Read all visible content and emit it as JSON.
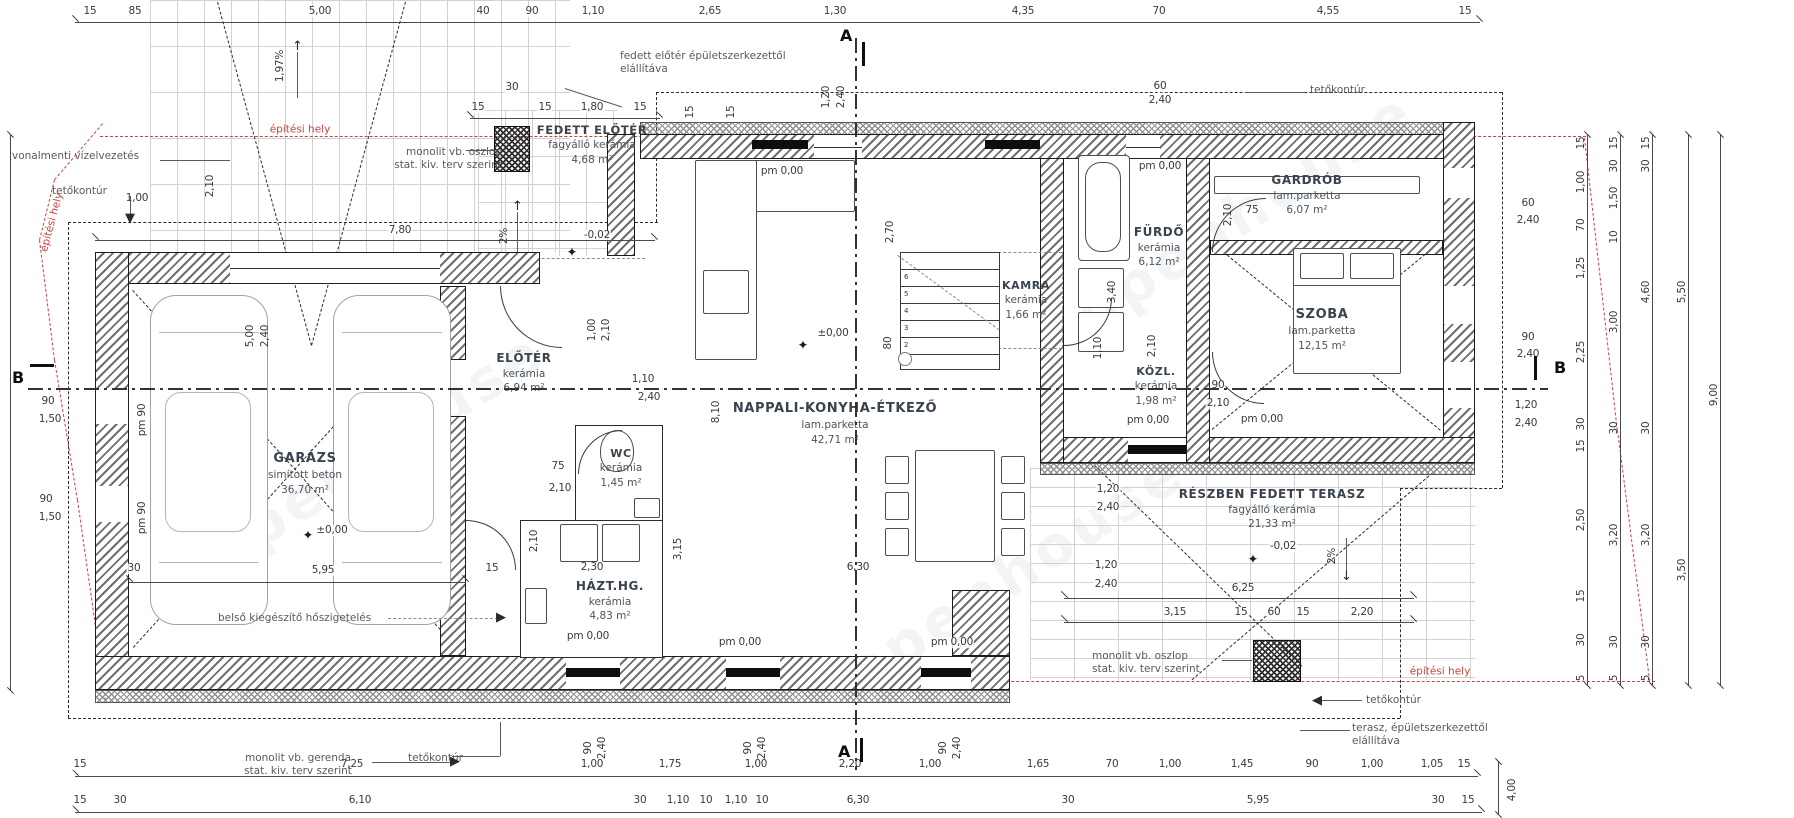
{
  "title": "Földszinti alaprajz",
  "colors": {
    "ink": "#1c1c1c",
    "dim_text": "#3a3a3a",
    "room_text": "#3a434e",
    "site_red": "#c6463e",
    "brick_gray": "#d2d2d2"
  },
  "rooms": [
    {
      "name": "GARÁZS",
      "finish": "simított beton",
      "area": "36,70 m²"
    },
    {
      "name": "FEDETT ELŐTÉR",
      "finish": "fagyálló kerámia",
      "area": "4,68 m²"
    },
    {
      "name": "ELŐTÉR",
      "finish": "kerámia",
      "area": "6,94 m²"
    },
    {
      "name": "WC",
      "finish": "kerámia",
      "area": "1,45 m²"
    },
    {
      "name": "HÁZT.HG.",
      "finish": "kerámia",
      "area": "4,83 m²"
    },
    {
      "name": "NAPPALI-KONYHA-ÉTKEZŐ",
      "finish": "lam.parketta",
      "area": "42,71 m²"
    },
    {
      "name": "KAMRA",
      "finish": "kerámia",
      "area": "1,66 m²"
    },
    {
      "name": "FÜRDŐ",
      "finish": "kerámia",
      "area": "6,12 m²"
    },
    {
      "name": "KÖZL.",
      "finish": "kerámia",
      "area": "1,98 m²"
    },
    {
      "name": "GARDRÓB",
      "finish": "lam.parketta",
      "area": "6,07 m²"
    },
    {
      "name": "SZOBA",
      "finish": "lam.parketta",
      "area": "12,15 m²"
    },
    {
      "name": "RÉSZBEN FEDETT TERASZ",
      "finish": "fagyálló kerámia",
      "area": "21,33 m²"
    }
  ],
  "levels": {
    "pm000": "pm 0,00",
    "pm90": "pm 90",
    "zero": "±0,00",
    "minus": "-0,02"
  },
  "sections": {
    "a": "A",
    "b": "B"
  },
  "annotations": {
    "vonalmenti": "vonalmenti vízelvezetés",
    "tetokontur": "tetőkontúr",
    "epitesi_hely": "építési hely",
    "oszlop_l1": "monolit vb. oszlop",
    "oszlop_l2": "stat. kiv. terv szerint",
    "gerenda_l1": "monolit vb. gerenda",
    "gerenda_l2": "stat. kiv. terv szerint",
    "belso": "belső kiegészítő hőszigetelés",
    "fedett_l1": "fedett előtér épületszerkezettől",
    "fedett_l2": "elállítáva",
    "terasz_l1": "terasz, épületszerkezettől",
    "terasz_l2": "elállítáva",
    "slope197": "1,97%",
    "slope2": "2%",
    "watermark": "openhouse"
  },
  "dims": {
    "top": [
      "15",
      "85",
      "5,00",
      "40",
      "90",
      "1,10",
      "2,65",
      "1,30",
      "4,35",
      "70",
      "4,55",
      "15"
    ],
    "top2": [
      "30",
      "15",
      "15",
      "1,80",
      "15"
    ],
    "d780": "7,80",
    "d100": "1,00",
    "wA": [
      "1,20",
      "2,40"
    ],
    "w15": "15",
    "w60": [
      "60",
      "2,40"
    ],
    "rw": [
      "60",
      "2,40",
      "90",
      "2,40",
      "1,20",
      "2,40"
    ],
    "chainA": [
      "15",
      "1,00",
      "70",
      "1,25",
      "2,25",
      "30",
      "15",
      "2,50",
      "15",
      "30",
      "5"
    ],
    "chainB": [
      "15",
      "30",
      "1,50",
      "10",
      "3,00",
      "30",
      "3,20",
      "30",
      "5"
    ],
    "chainC": [
      "15",
      "30",
      "4,60",
      "30",
      "3,20",
      "30",
      "5"
    ],
    "chainD": [
      "5,50",
      "3,50"
    ],
    "chainE": [
      "9,00"
    ],
    "bottom1": [
      "15",
      "7,25",
      "1,00",
      "1,75",
      "1,00",
      "2,20",
      "1,00",
      "1,65",
      "70",
      "1,00",
      "1,45",
      "90",
      "1,00",
      "1,05",
      "15"
    ],
    "bottom2": [
      "15",
      "30",
      "6,10",
      "30",
      "1,10",
      "10",
      "1,10",
      "10",
      "6,30",
      "30",
      "5,95",
      "30",
      "15"
    ],
    "d400": "4,00",
    "door90": "90",
    "door240": "2,40",
    "w90": "90",
    "w150": "1,50",
    "garage": [
      "5,00",
      "2,40",
      "5,95",
      "30",
      "15"
    ],
    "terasz": [
      "6,25",
      "3,15",
      "15",
      "60",
      "15",
      "2,20",
      "1,20",
      "2,40",
      "1,20",
      "2,40"
    ],
    "interior": [
      "8,10",
      "2,40",
      "1,10",
      "3,15",
      "2,30",
      "2,70",
      "80",
      "3,40",
      "2,10",
      "75",
      "90",
      "2,10",
      "6,30",
      "75",
      "2,10",
      "2,10",
      "1,00",
      "2,10",
      "1,10",
      "2,10",
      "2,10"
    ]
  }
}
